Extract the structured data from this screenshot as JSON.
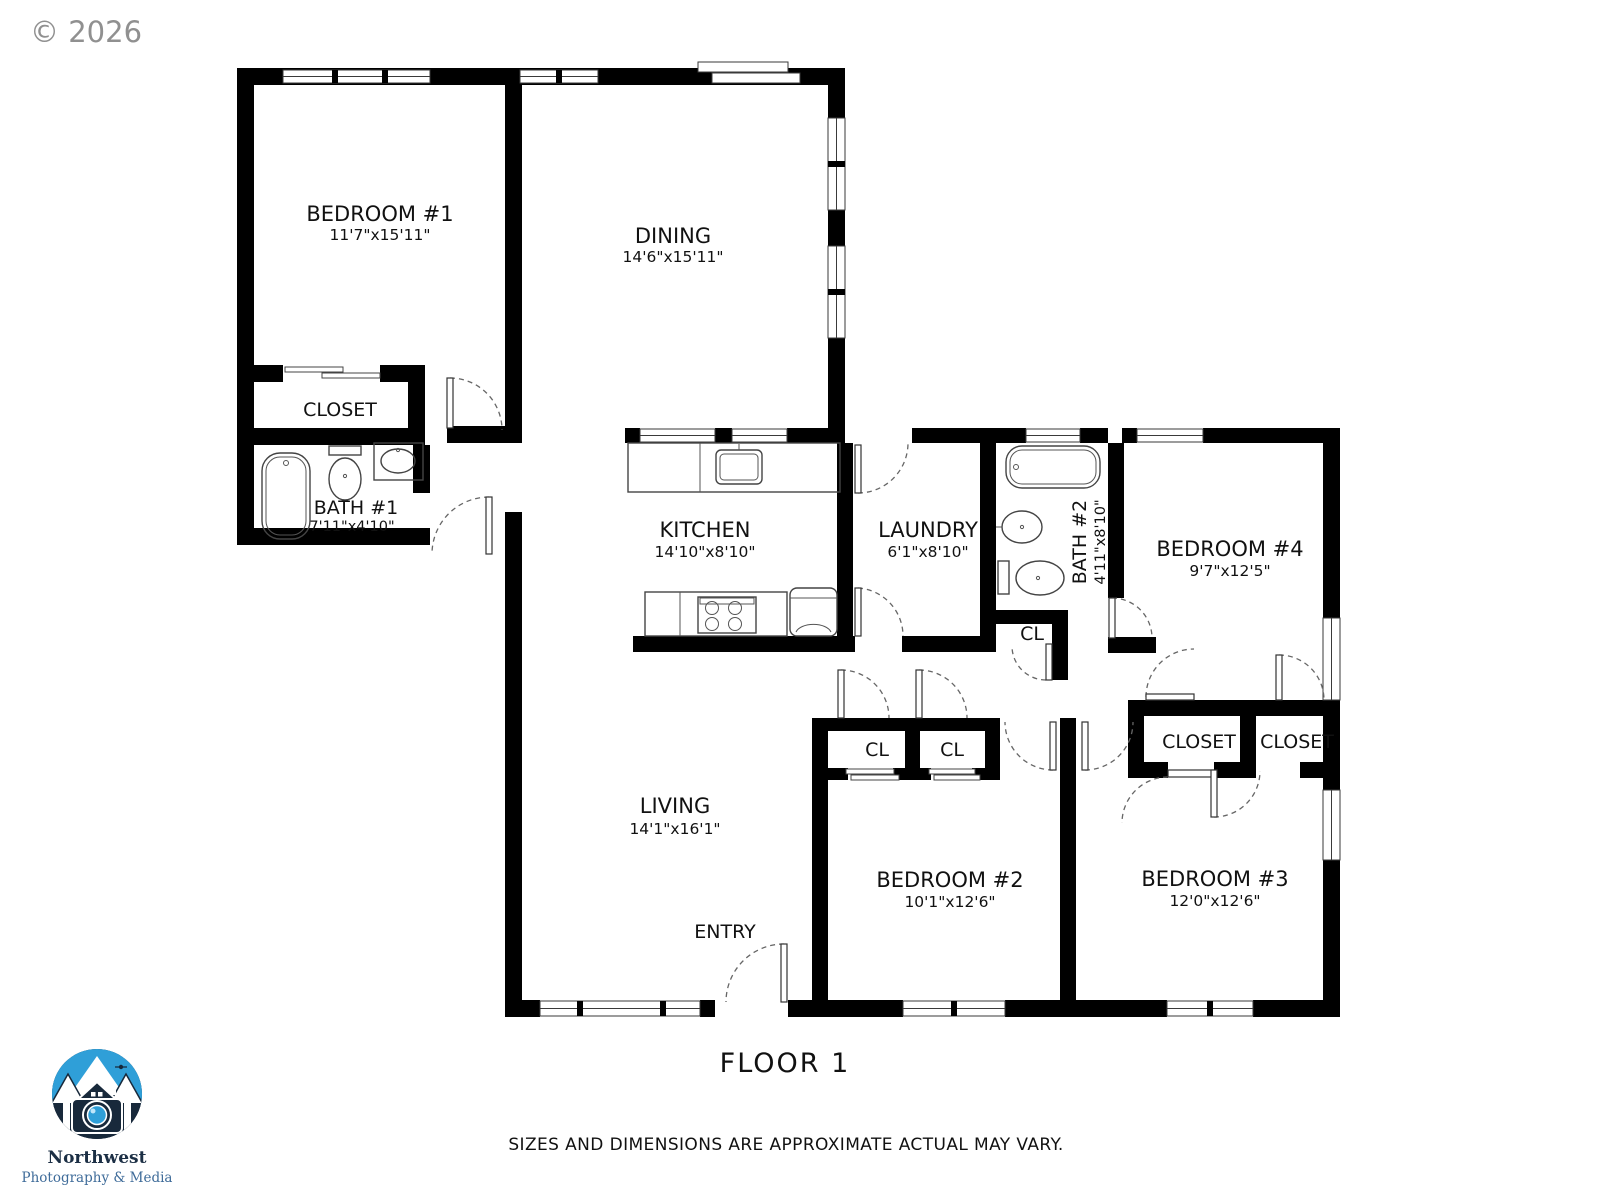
{
  "meta": {
    "copyright": "© 2026",
    "floor_label": "FLOOR 1",
    "disclaimer": "SIZES AND DIMENSIONS ARE APPROXIMATE ACTUAL MAY VARY."
  },
  "logo": {
    "line1": "Northwest",
    "line2": "Photography & Media"
  },
  "rooms": {
    "bedroom1": {
      "name": "BEDROOM #1",
      "dims": "11'7\"x15'11\""
    },
    "dining": {
      "name": "DINING",
      "dims": "14'6\"x15'11\""
    },
    "closet1": {
      "name": "CLOSET"
    },
    "bath1": {
      "name": "BATH #1",
      "dims": "7'11\"x4'10\""
    },
    "kitchen": {
      "name": "KITCHEN",
      "dims": "14'10\"x8'10\""
    },
    "laundry": {
      "name": "LAUNDRY",
      "dims": "6'1\"x8'10\""
    },
    "bath2": {
      "name": "BATH #2",
      "dims": "4'11\"x8'10\""
    },
    "bedroom4": {
      "name": "BEDROOM #4",
      "dims": "9'7\"x12'5\""
    },
    "cl_bath2": {
      "name": "CL"
    },
    "cl_left": {
      "name": "CL"
    },
    "cl_right": {
      "name": "CL"
    },
    "closet_b3_left": {
      "name": "CLOSET"
    },
    "closet_b3_right": {
      "name": "CLOSET"
    },
    "living": {
      "name": "LIVING",
      "dims": "14'1\"x16'1\""
    },
    "entry": {
      "name": "ENTRY"
    },
    "bedroom2": {
      "name": "BEDROOM #2",
      "dims": "10'1\"x12'6\""
    },
    "bedroom3": {
      "name": "BEDROOM #3",
      "dims": "12'0\"x12'6\""
    }
  },
  "colors": {
    "wall": "#000000",
    "copyright_gray": "#909090",
    "logo_navy": "#18293b",
    "logo_blue": "#2f9fd8",
    "logo_text_dark": "#1c2f45",
    "logo_text_blue": "#3e6b99"
  }
}
